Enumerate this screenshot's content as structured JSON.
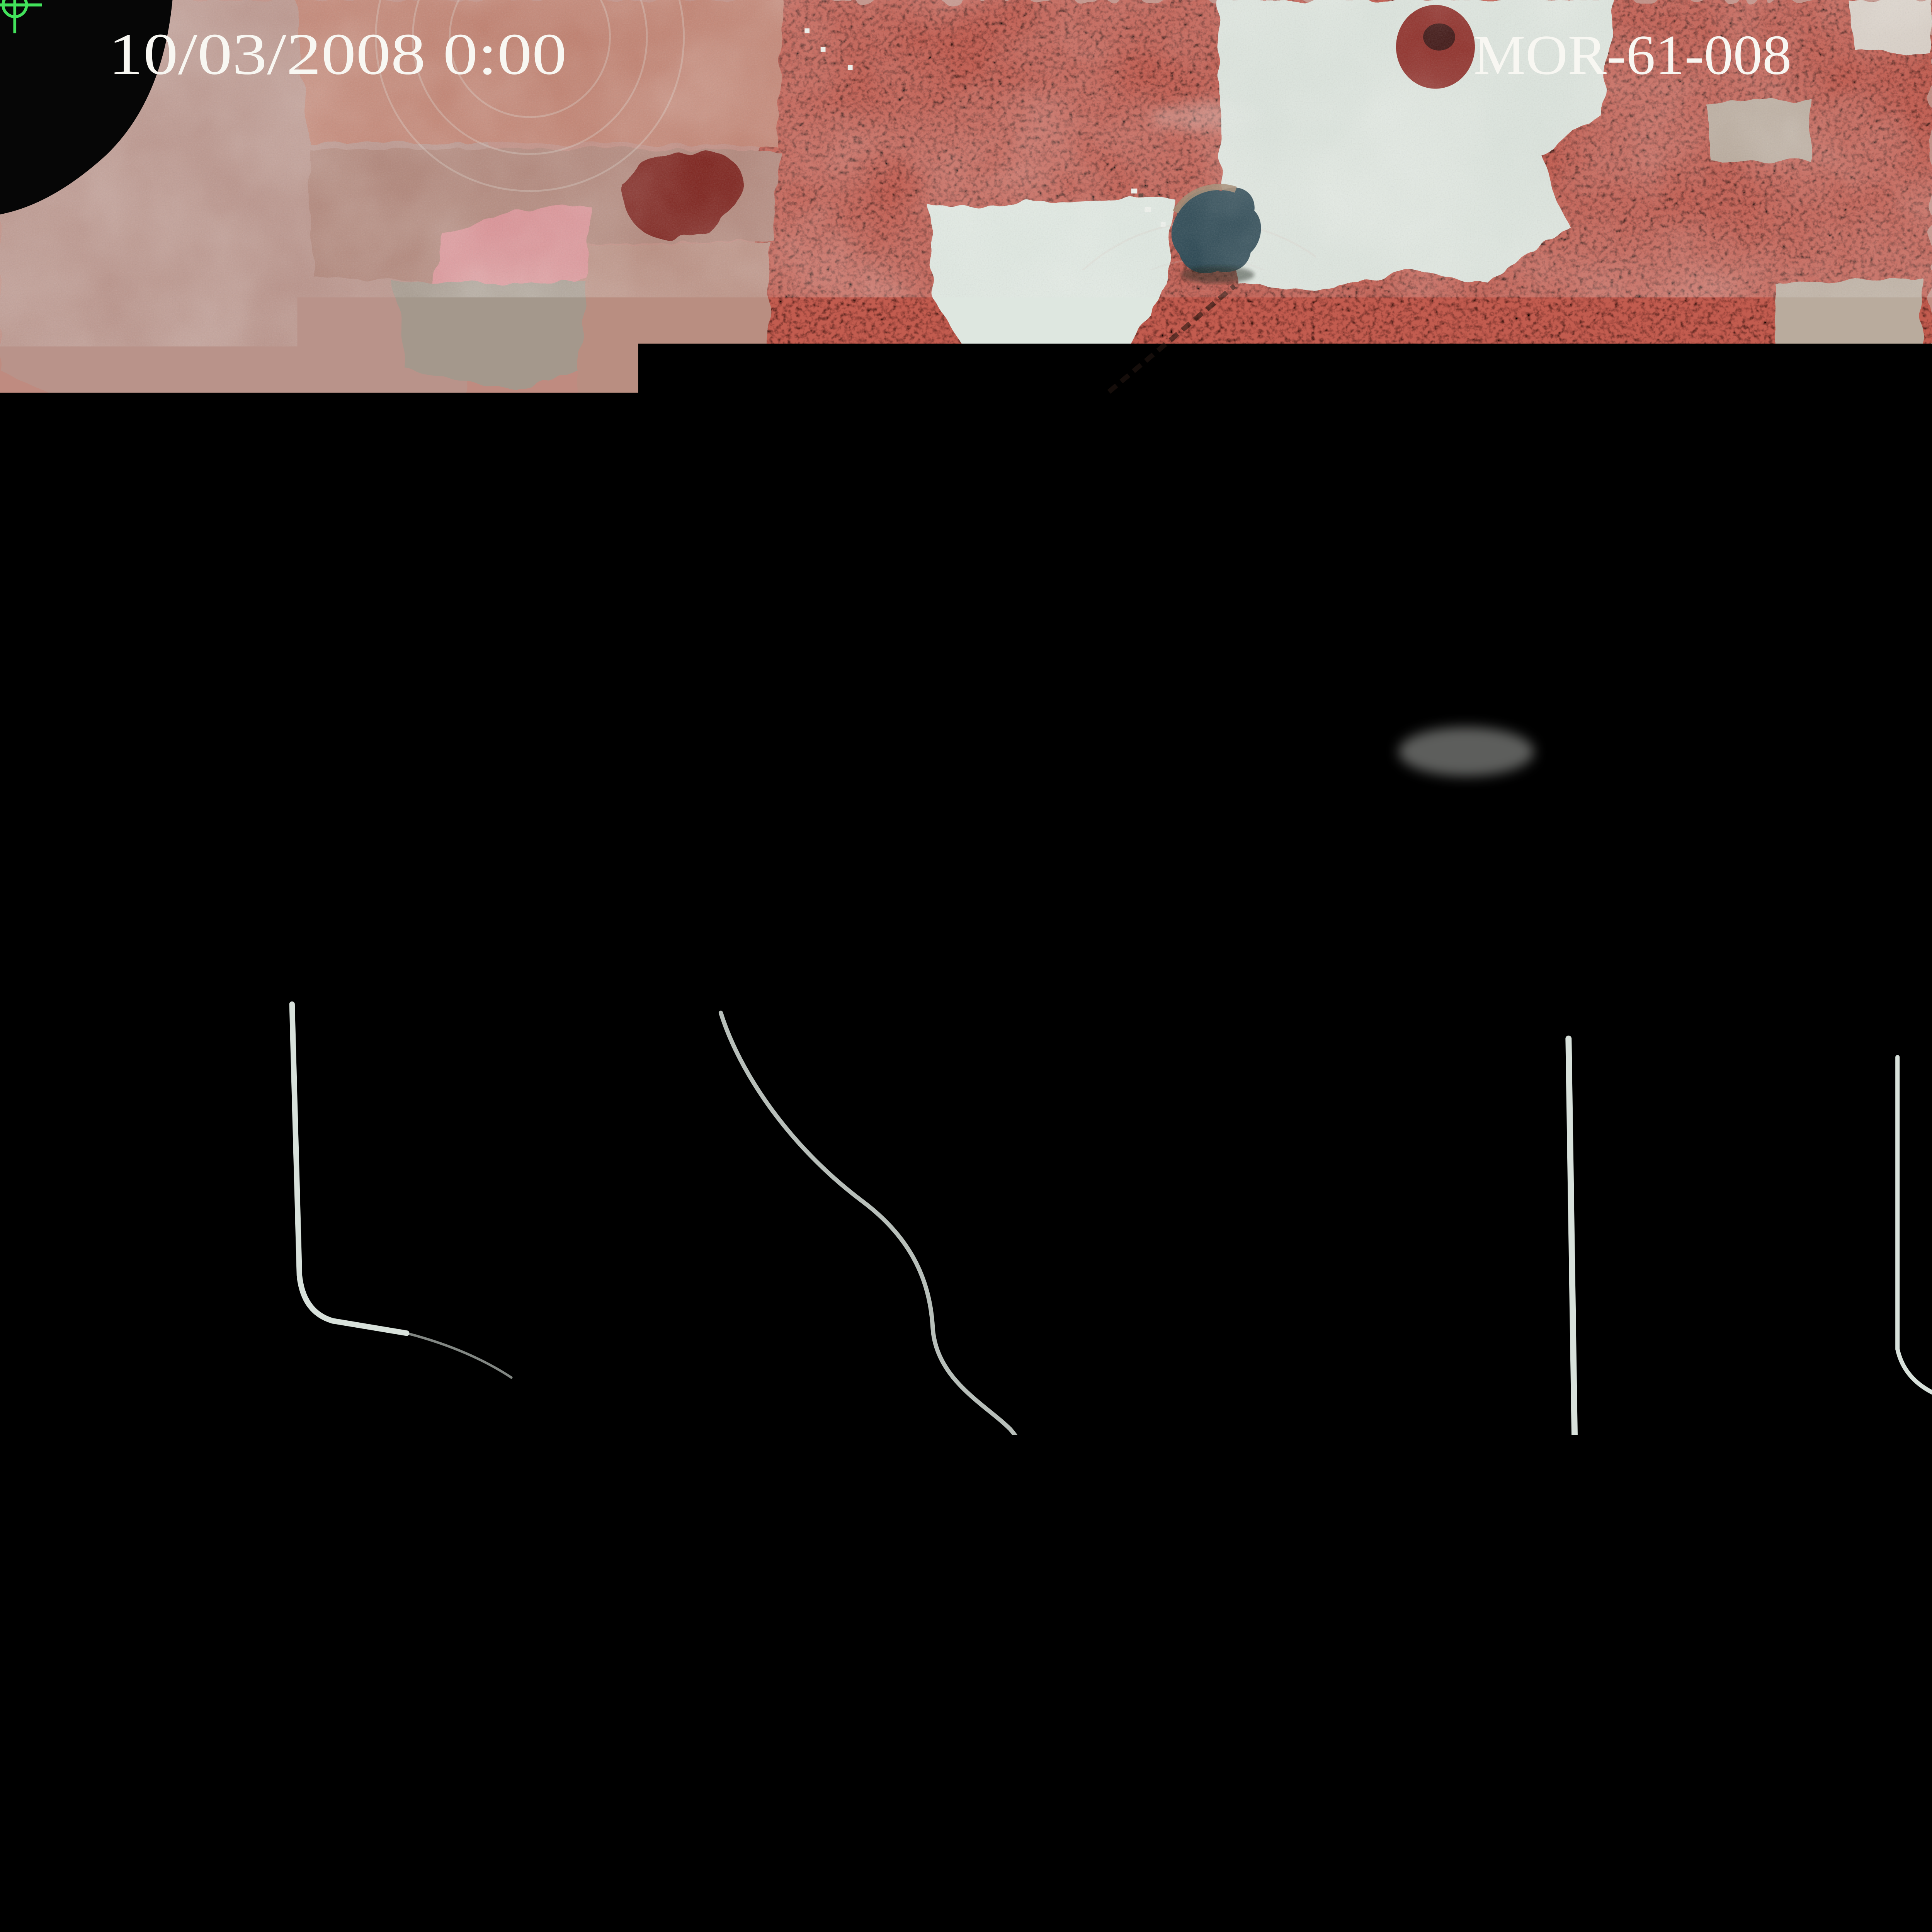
{
  "image": {
    "kind": "color-infrared aerial survey photograph",
    "datetime_stamp": "10/03/2008 0:00",
    "photo_id": "MOR-61-008",
    "runway_number": "31"
  },
  "colors": {
    "annotation_text": "#f8f7f2",
    "fiducial_green": "#42e25b",
    "film_black": "#060606",
    "forest_red": "#c25b50",
    "field_pale": "#dde4dc",
    "pond_dark": "#24414d",
    "road_light": "#d8e1db",
    "runway_dark": "#47564e"
  },
  "icons": [
    {
      "name": "fiducial-crosshair-icon-top-left",
      "glyph": "circle with plus cross"
    },
    {
      "name": "fiducial-cross-icon-bottom-left",
      "glyph": "circle with X cross and three index bars"
    },
    {
      "name": "fiducial-crosshair-icon-bottom-right",
      "glyph": "circle with plus cross and two dots"
    }
  ]
}
